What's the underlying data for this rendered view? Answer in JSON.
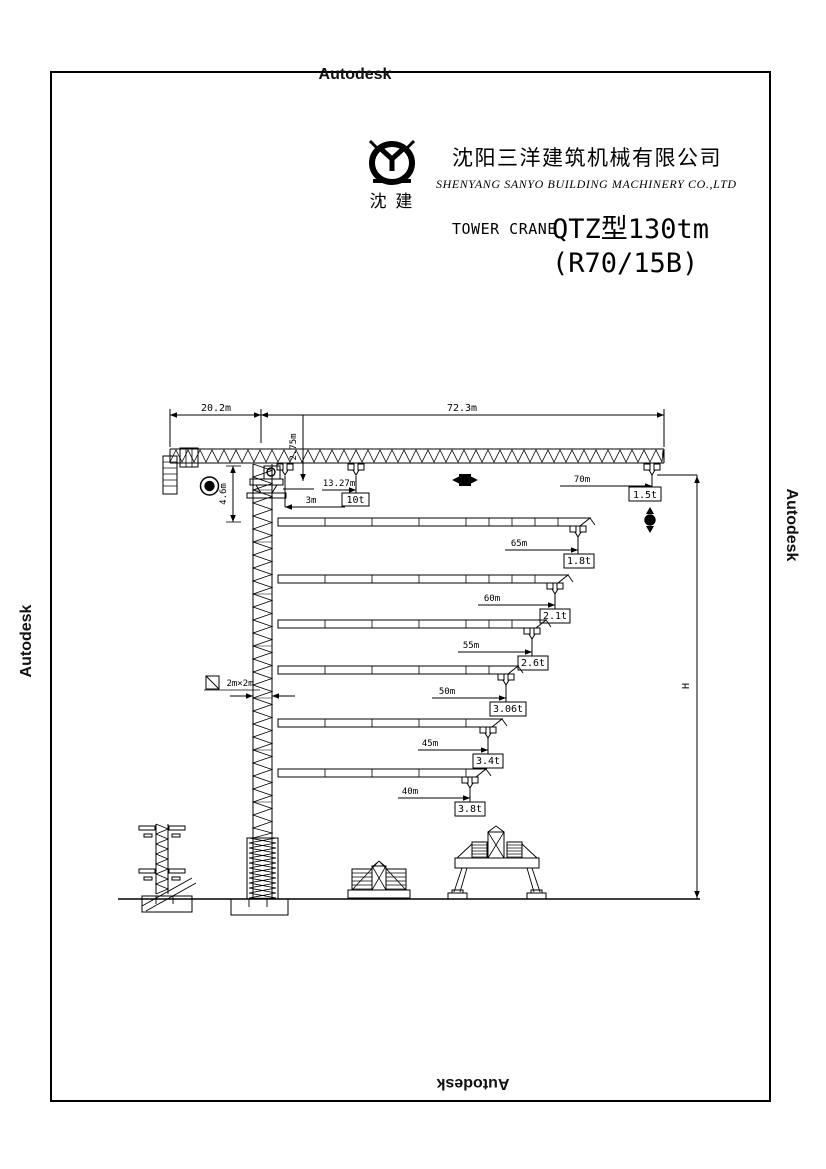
{
  "watermarks": {
    "top": "Autodesk",
    "left": "Autodesk",
    "right": "Autodesk",
    "bottom": "Autodesk"
  },
  "header": {
    "logo_text": "沈 建",
    "company_cn": "沈阳三洋建筑机械有限公司",
    "company_en": "SHENYANG SANYO BUILDING MACHINERY CO.,LTD",
    "type_label": "TOWER CRANE",
    "model": "QTZ型130tm",
    "variant": "(R70/15B)"
  },
  "drawing": {
    "dims": {
      "counter_jib_length": "20.2m",
      "jib_length": "72.3m",
      "jib_section_height": "2.75m",
      "tower_head_height": "4.6m",
      "min_radius": "3m",
      "max_load_radius": "13.27m",
      "max_load": "10t",
      "tip_radius": "70m",
      "tip_load": "1.5t",
      "mast_section": "2m×2m",
      "height_label": "H"
    },
    "jib_configs": [
      {
        "radius": "65m",
        "load": "1.8t"
      },
      {
        "radius": "60m",
        "load": "2.1t"
      },
      {
        "radius": "55m",
        "load": "2.6t"
      },
      {
        "radius": "50m",
        "load": "3.06t"
      },
      {
        "radius": "45m",
        "load": "3.4t"
      },
      {
        "radius": "40m",
        "load": "3.8t"
      }
    ]
  }
}
